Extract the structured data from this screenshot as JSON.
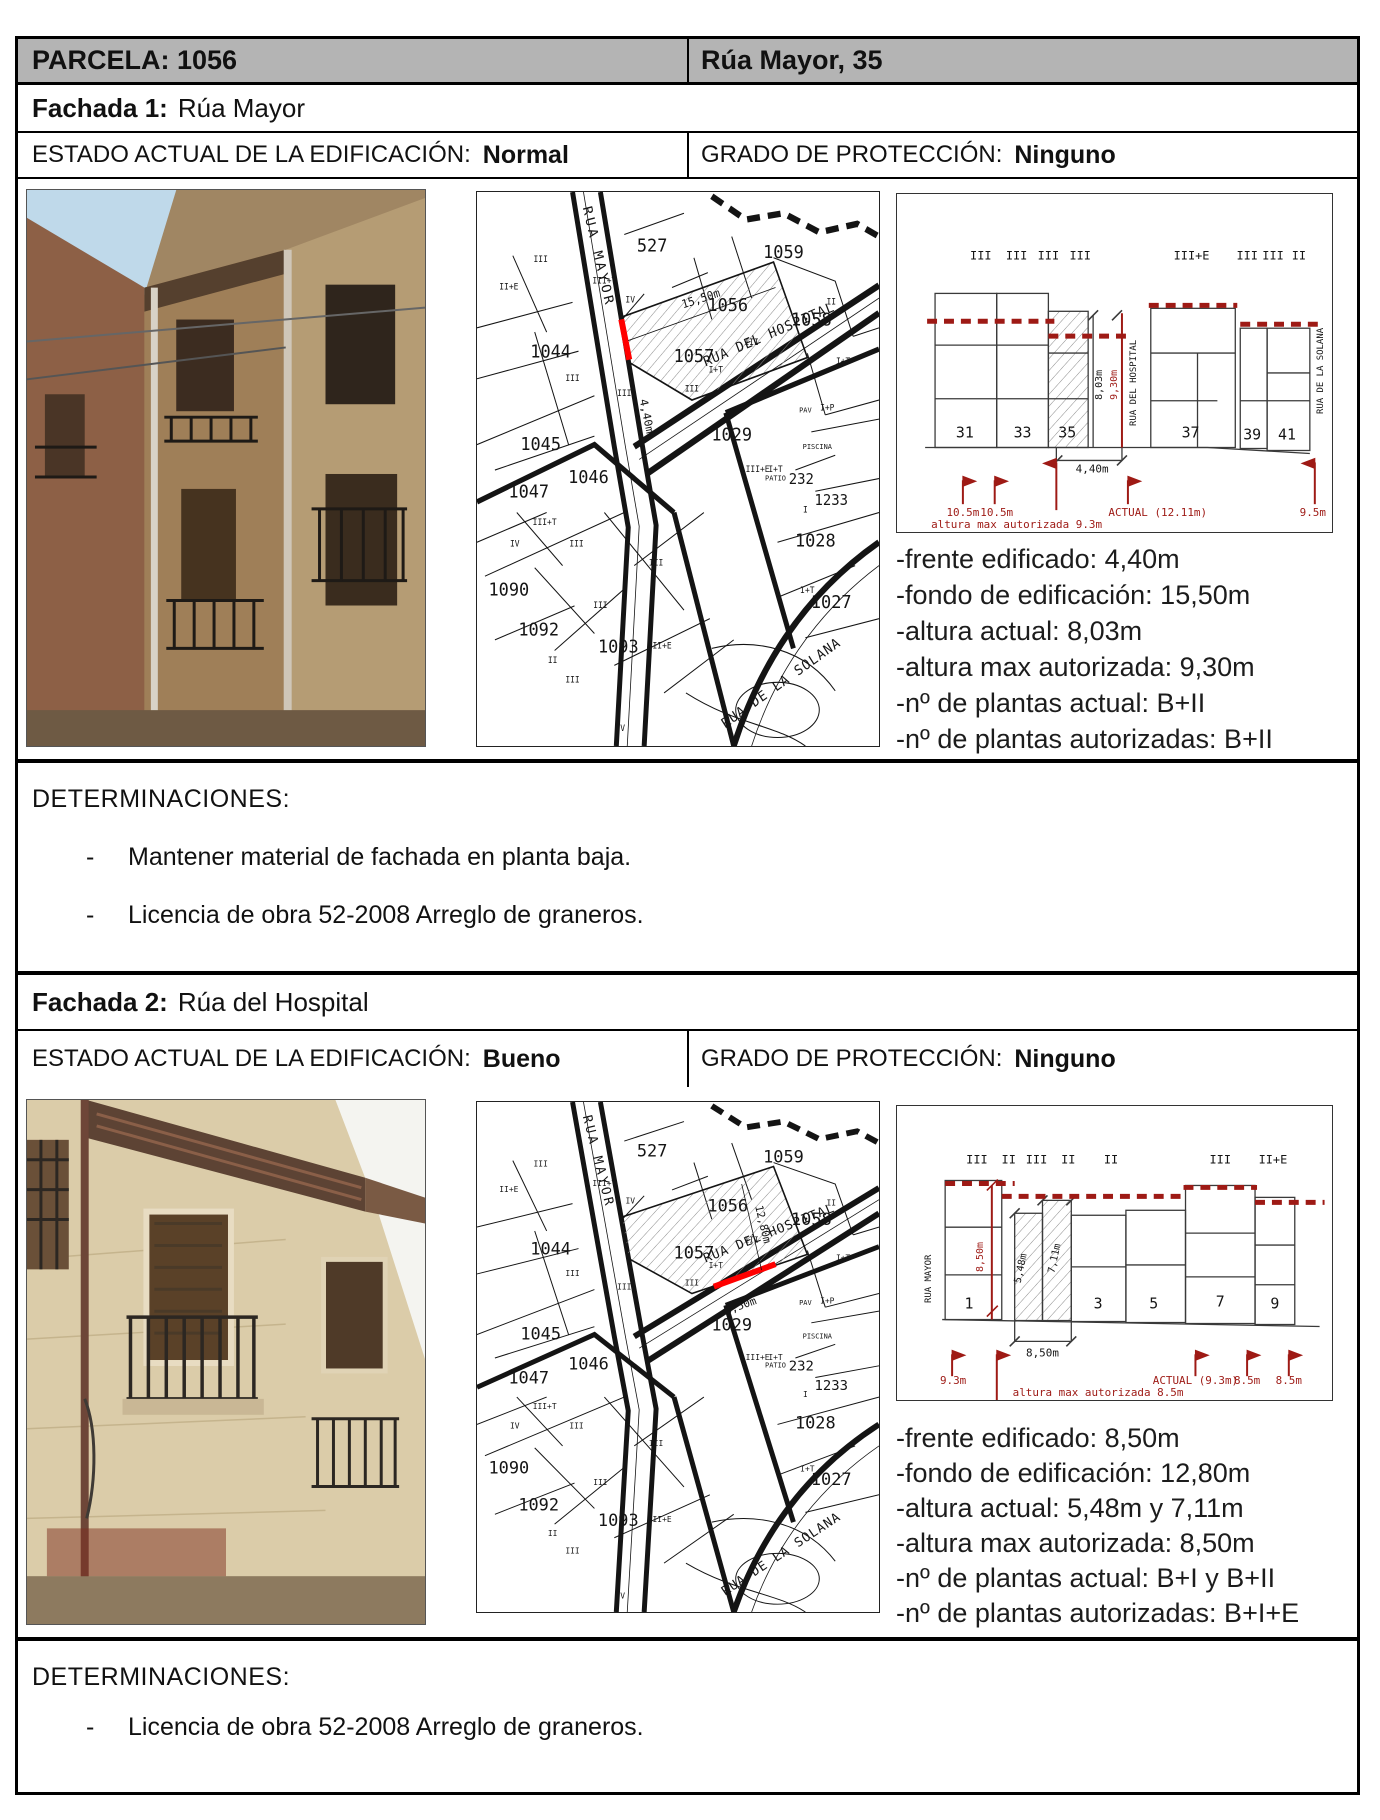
{
  "bullet": "-",
  "colors": {
    "accent_red": "#9e1a15",
    "highlight_red": "#ff0000",
    "header_gray": "#b4b4b4"
  },
  "header": {
    "parcela": "PARCELA: 1056",
    "address": "Rúa Mayor, 35"
  },
  "sections": [
    {
      "fachada_label": "Fachada 1:",
      "fachada_name": "Rúa Mayor",
      "estado_label": "ESTADO ACTUAL DE LA EDIFICACIÓN:",
      "estado_value": "Normal",
      "grado_label": "GRADO DE PROTECCIÓN:",
      "grado_value": "Ninguno",
      "details": [
        "-frente edificado: 4,40m",
        "-fondo de edificación: 15,50m",
        "-altura actual: 8,03m",
        "-altura max autorizada: 9,30m",
        "-nº de plantas actual: B+II",
        "-nº de plantas autorizadas: B+II"
      ],
      "determinaciones_title": "DETERMINACIONES:",
      "determinaciones": [
        "Mantener material de fachada en planta baja.",
        "Licencia de obra 52-2008 Arreglo de graneros."
      ],
      "map_labels": [
        {
          "t": "RUA MAYOR",
          "x": 118,
          "y": 62,
          "r": 76,
          "s": 13,
          "sp": 3
        },
        {
          "t": "RUA DEL HOSPITAL",
          "x": 295,
          "y": 138,
          "r": -22,
          "s": 13,
          "sp": 1
        },
        {
          "t": "RUA DE LA SOLANA",
          "x": 308,
          "y": 466,
          "r": -34,
          "s": 13,
          "sp": 1
        },
        {
          "t": "527",
          "x": 176,
          "y": 56,
          "s": 17
        },
        {
          "t": "1059",
          "x": 308,
          "y": 62,
          "s": 17
        },
        {
          "t": "1058",
          "x": 336,
          "y": 126,
          "s": 17
        },
        {
          "t": "1056",
          "x": 252,
          "y": 112,
          "s": 17
        },
        {
          "t": "1057",
          "x": 218,
          "y": 160,
          "s": 17
        },
        {
          "t": "1044",
          "x": 74,
          "y": 156,
          "s": 17
        },
        {
          "t": "1045",
          "x": 64,
          "y": 243,
          "s": 17
        },
        {
          "t": "1047",
          "x": 52,
          "y": 288,
          "s": 17
        },
        {
          "t": "1046",
          "x": 112,
          "y": 274,
          "s": 17
        },
        {
          "t": "1029",
          "x": 256,
          "y": 234,
          "s": 17
        },
        {
          "t": "1028",
          "x": 340,
          "y": 334,
          "s": 17
        },
        {
          "t": "1027",
          "x": 356,
          "y": 392,
          "s": 17
        },
        {
          "t": "1090",
          "x": 32,
          "y": 380,
          "s": 17
        },
        {
          "t": "1092",
          "x": 62,
          "y": 418,
          "s": 17
        },
        {
          "t": "1093",
          "x": 142,
          "y": 434,
          "s": 17
        },
        {
          "t": "PATIO",
          "x": 300,
          "y": 272,
          "s": 7
        },
        {
          "t": "232",
          "x": 326,
          "y": 275,
          "s": 14
        },
        {
          "t": "1233",
          "x": 356,
          "y": 295,
          "s": 14
        },
        {
          "t": "II+E",
          "x": 32,
          "y": 92,
          "s": 8
        },
        {
          "t": "III",
          "x": 64,
          "y": 66,
          "s": 8
        },
        {
          "t": "III+T",
          "x": 128,
          "y": 86,
          "s": 8
        },
        {
          "t": "IV",
          "x": 154,
          "y": 104,
          "s": 8
        },
        {
          "t": "II",
          "x": 356,
          "y": 106,
          "s": 8
        },
        {
          "t": "III",
          "x": 276,
          "y": 144,
          "s": 8
        },
        {
          "t": "I+T",
          "x": 240,
          "y": 170,
          "s": 8
        },
        {
          "t": "III",
          "x": 96,
          "y": 178,
          "s": 8
        },
        {
          "t": "III",
          "x": 148,
          "y": 192,
          "s": 8
        },
        {
          "t": "III",
          "x": 216,
          "y": 188,
          "s": 8
        },
        {
          "t": "I+T",
          "x": 368,
          "y": 162,
          "s": 8
        },
        {
          "t": "PAV",
          "x": 330,
          "y": 208,
          "s": 7
        },
        {
          "t": "I+P",
          "x": 352,
          "y": 206,
          "s": 8
        },
        {
          "t": "PISCINA",
          "x": 342,
          "y": 242,
          "s": 7
        },
        {
          "t": "I+T",
          "x": 300,
          "y": 264,
          "s": 8
        },
        {
          "t": "I",
          "x": 330,
          "y": 302,
          "s": 8
        },
        {
          "t": "III+T",
          "x": 68,
          "y": 314,
          "s": 8
        },
        {
          "t": "III",
          "x": 100,
          "y": 334,
          "s": 8
        },
        {
          "t": "III+E",
          "x": 282,
          "y": 264,
          "s": 8
        },
        {
          "t": "I+T",
          "x": 332,
          "y": 378,
          "s": 8
        },
        {
          "t": "IV",
          "x": 38,
          "y": 334,
          "s": 8
        },
        {
          "t": "III",
          "x": 180,
          "y": 352,
          "s": 8
        },
        {
          "t": "III",
          "x": 124,
          "y": 392,
          "s": 8
        },
        {
          "t": "II",
          "x": 76,
          "y": 444,
          "s": 8
        },
        {
          "t": "III",
          "x": 96,
          "y": 462,
          "s": 8
        },
        {
          "t": "II+E",
          "x": 186,
          "y": 430,
          "s": 8
        },
        {
          "t": "IV",
          "x": 144,
          "y": 508,
          "s": 8
        },
        {
          "t": "15,50m",
          "x": 226,
          "y": 104,
          "r": -17,
          "s": 11
        },
        {
          "t": "4,40m",
          "x": 167,
          "y": 212,
          "r": 78,
          "s": 11
        }
      ],
      "elev_labels": [
        {
          "t": "III",
          "x": 84,
          "y": 66,
          "s": 12
        },
        {
          "t": "III",
          "x": 120,
          "y": 66,
          "s": 12
        },
        {
          "t": "III",
          "x": 152,
          "y": 66,
          "s": 12
        },
        {
          "t": "III",
          "x": 184,
          "y": 66,
          "s": 12
        },
        {
          "t": "III+E",
          "x": 296,
          "y": 66,
          "s": 12
        },
        {
          "t": "III",
          "x": 352,
          "y": 66,
          "s": 12
        },
        {
          "t": "III",
          "x": 378,
          "y": 66,
          "s": 12
        },
        {
          "t": "II",
          "x": 404,
          "y": 66,
          "s": 12
        },
        {
          "t": "RUA DEL HOSPITAL",
          "x": 240,
          "y": 190,
          "r": -90,
          "s": 9
        },
        {
          "t": "RUA DE LA SOLANA",
          "x": 428,
          "y": 178,
          "r": -90,
          "s": 9
        },
        {
          "t": "31",
          "x": 68,
          "y": 245,
          "s": 15
        },
        {
          "t": "33",
          "x": 126,
          "y": 245,
          "s": 15
        },
        {
          "t": "35",
          "x": 171,
          "y": 245,
          "s": 15
        },
        {
          "t": "37",
          "x": 295,
          "y": 245,
          "s": 15
        },
        {
          "t": "39",
          "x": 357,
          "y": 247,
          "s": 15
        },
        {
          "t": "41",
          "x": 392,
          "y": 247,
          "s": 15
        },
        {
          "t": "8,03m",
          "x": 206,
          "y": 192,
          "r": -90,
          "s": 10
        },
        {
          "t": "9,30m",
          "x": 221,
          "y": 192,
          "r": -90,
          "s": 10,
          "c": "red"
        },
        {
          "t": "4,40m",
          "x": 196,
          "y": 280,
          "s": 11
        },
        {
          "t": "10.5m",
          "x": 66,
          "y": 324,
          "s": 11,
          "c": "red"
        },
        {
          "t": "10.5m",
          "x": 100,
          "y": 324,
          "s": 11,
          "c": "red"
        },
        {
          "t": "ACTUAL (12.11m)",
          "x": 262,
          "y": 324,
          "s": 11,
          "c": "red"
        },
        {
          "t": "9.5m",
          "x": 418,
          "y": 324,
          "s": 11,
          "c": "red"
        },
        {
          "t": "altura max autorizada 9.3m",
          "x": 34,
          "y": 336,
          "s": 11,
          "c": "red",
          "a": "start"
        }
      ]
    },
    {
      "fachada_label": "Fachada 2:",
      "fachada_name": "Rúa del Hospital",
      "estado_label": "ESTADO ACTUAL DE LA EDIFICACIÓN:",
      "estado_value": "Bueno",
      "grado_label": "GRADO DE PROTECCIÓN:",
      "grado_value": "Ninguno",
      "details": [
        "-frente edificado: 8,50m",
        "-fondo de edificación: 12,80m",
        "-altura actual: 5,48m y 7,11m",
        "-altura max autorizada: 8,50m",
        "-nº de plantas actual: B+I y B+II",
        "-nº de plantas autorizadas: B+I+E"
      ],
      "determinaciones_title": "DETERMINACIONES:",
      "determinaciones": [
        "Licencia de obra 52-2008 Arreglo de graneros."
      ],
      "map_labels": [
        {
          "t": "RUA MAYOR",
          "x": 118,
          "y": 62,
          "r": 76,
          "s": 13,
          "sp": 3
        },
        {
          "t": "RUA DEL HOSPITAL",
          "x": 295,
          "y": 138,
          "r": -22,
          "s": 13,
          "sp": 1
        },
        {
          "t": "RUA DE LA SOLANA",
          "x": 308,
          "y": 466,
          "r": -34,
          "s": 13,
          "sp": 1
        },
        {
          "t": "527",
          "x": 176,
          "y": 56,
          "s": 17
        },
        {
          "t": "1059",
          "x": 308,
          "y": 62,
          "s": 17
        },
        {
          "t": "1058",
          "x": 336,
          "y": 126,
          "s": 17
        },
        {
          "t": "1056",
          "x": 252,
          "y": 112,
          "s": 17
        },
        {
          "t": "1057",
          "x": 218,
          "y": 160,
          "s": 17
        },
        {
          "t": "1044",
          "x": 74,
          "y": 156,
          "s": 17
        },
        {
          "t": "1045",
          "x": 64,
          "y": 243,
          "s": 17
        },
        {
          "t": "1047",
          "x": 52,
          "y": 288,
          "s": 17
        },
        {
          "t": "1046",
          "x": 112,
          "y": 274,
          "s": 17
        },
        {
          "t": "1029",
          "x": 256,
          "y": 234,
          "s": 17
        },
        {
          "t": "1028",
          "x": 340,
          "y": 334,
          "s": 17
        },
        {
          "t": "1027",
          "x": 356,
          "y": 392,
          "s": 17
        },
        {
          "t": "1090",
          "x": 32,
          "y": 380,
          "s": 17
        },
        {
          "t": "1092",
          "x": 62,
          "y": 418,
          "s": 17
        },
        {
          "t": "1093",
          "x": 142,
          "y": 434,
          "s": 17
        },
        {
          "t": "PATIO",
          "x": 300,
          "y": 272,
          "s": 7
        },
        {
          "t": "232",
          "x": 326,
          "y": 275,
          "s": 14
        },
        {
          "t": "1233",
          "x": 356,
          "y": 295,
          "s": 14
        },
        {
          "t": "II+E",
          "x": 32,
          "y": 92,
          "s": 8
        },
        {
          "t": "III",
          "x": 64,
          "y": 66,
          "s": 8
        },
        {
          "t": "III+T",
          "x": 128,
          "y": 86,
          "s": 8
        },
        {
          "t": "IV",
          "x": 154,
          "y": 104,
          "s": 8
        },
        {
          "t": "II",
          "x": 356,
          "y": 106,
          "s": 8
        },
        {
          "t": "III",
          "x": 276,
          "y": 144,
          "s": 8
        },
        {
          "t": "I+T",
          "x": 240,
          "y": 170,
          "s": 8
        },
        {
          "t": "III",
          "x": 96,
          "y": 178,
          "s": 8
        },
        {
          "t": "III",
          "x": 148,
          "y": 192,
          "s": 8
        },
        {
          "t": "III",
          "x": 216,
          "y": 188,
          "s": 8
        },
        {
          "t": "I+T",
          "x": 368,
          "y": 162,
          "s": 8
        },
        {
          "t": "PAV",
          "x": 330,
          "y": 208,
          "s": 7
        },
        {
          "t": "I+P",
          "x": 352,
          "y": 206,
          "s": 8
        },
        {
          "t": "PISCINA",
          "x": 342,
          "y": 242,
          "s": 7
        },
        {
          "t": "I+T",
          "x": 300,
          "y": 264,
          "s": 8
        },
        {
          "t": "I",
          "x": 330,
          "y": 302,
          "s": 8
        },
        {
          "t": "III+T",
          "x": 68,
          "y": 314,
          "s": 8
        },
        {
          "t": "III",
          "x": 100,
          "y": 334,
          "s": 8
        },
        {
          "t": "III+E",
          "x": 282,
          "y": 264,
          "s": 8
        },
        {
          "t": "I+T",
          "x": 332,
          "y": 378,
          "s": 8
        },
        {
          "t": "IV",
          "x": 38,
          "y": 334,
          "s": 8
        },
        {
          "t": "III",
          "x": 180,
          "y": 352,
          "s": 8
        },
        {
          "t": "III",
          "x": 124,
          "y": 392,
          "s": 8
        },
        {
          "t": "II",
          "x": 76,
          "y": 444,
          "s": 8
        },
        {
          "t": "III",
          "x": 96,
          "y": 462,
          "s": 8
        },
        {
          "t": "II+E",
          "x": 186,
          "y": 430,
          "s": 8
        },
        {
          "t": "IV",
          "x": 144,
          "y": 508,
          "s": 8
        },
        {
          "t": "12,80m",
          "x": 284,
          "y": 126,
          "r": 77,
          "s": 11
        },
        {
          "t": "8,50m",
          "x": 266,
          "y": 212,
          "r": -20,
          "s": 11
        }
      ],
      "elev_labels": [
        {
          "t": "RUA MAYOR",
          "x": 34,
          "y": 174,
          "r": -90,
          "s": 9
        },
        {
          "t": "III",
          "x": 80,
          "y": 58,
          "s": 12
        },
        {
          "t": "II",
          "x": 112,
          "y": 58,
          "s": 12
        },
        {
          "t": "III",
          "x": 140,
          "y": 58,
          "s": 12
        },
        {
          "t": "II",
          "x": 172,
          "y": 58,
          "s": 12
        },
        {
          "t": "II",
          "x": 215,
          "y": 58,
          "s": 12
        },
        {
          "t": "III",
          "x": 325,
          "y": 58,
          "s": 12
        },
        {
          "t": "II+E",
          "x": 378,
          "y": 58,
          "s": 12
        },
        {
          "t": "1",
          "x": 72,
          "y": 204,
          "s": 15
        },
        {
          "t": "3",
          "x": 202,
          "y": 204,
          "s": 15
        },
        {
          "t": "5",
          "x": 258,
          "y": 204,
          "s": 15
        },
        {
          "t": "7",
          "x": 325,
          "y": 202,
          "s": 15
        },
        {
          "t": "9",
          "x": 380,
          "y": 204,
          "s": 15
        },
        {
          "t": "8,50m",
          "x": 86,
          "y": 152,
          "r": -90,
          "s": 10,
          "c": "red"
        },
        {
          "t": "5,48m",
          "x": 127,
          "y": 164,
          "r": -78,
          "s": 10
        },
        {
          "t": "7,11m",
          "x": 161,
          "y": 154,
          "r": -78,
          "s": 10
        },
        {
          "t": "8,50m",
          "x": 146,
          "y": 252,
          "s": 11
        },
        {
          "t": "9.3m",
          "x": 56,
          "y": 280,
          "s": 11,
          "c": "red"
        },
        {
          "t": "ACTUAL (9.3m)",
          "x": 300,
          "y": 280,
          "s": 11,
          "c": "red"
        },
        {
          "t": "8.5m",
          "x": 352,
          "y": 280,
          "s": 11,
          "c": "red"
        },
        {
          "t": "8.5m",
          "x": 394,
          "y": 280,
          "s": 11,
          "c": "red"
        },
        {
          "t": "altura max autorizada 8.5m",
          "x": 116,
          "y": 292,
          "s": 11,
          "c": "red",
          "a": "start"
        }
      ]
    }
  ]
}
